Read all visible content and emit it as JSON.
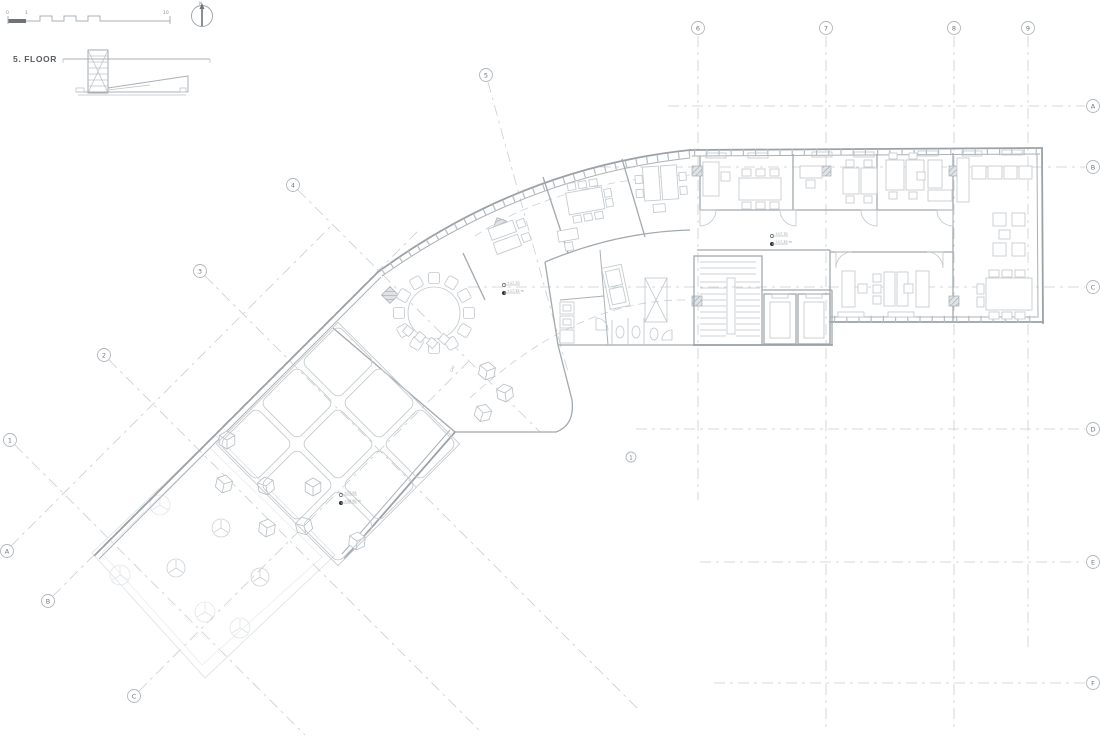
{
  "header": {
    "floor_label": "5. FLOOR",
    "north_label": "N",
    "scale_bar": {
      "zero": "0",
      "one": "1",
      "ten": "10"
    }
  },
  "grid": {
    "top": [
      "6",
      "7",
      "8",
      "9"
    ],
    "right": [
      "A",
      "B",
      "C",
      "D",
      "E",
      "F"
    ],
    "diag_numbers": [
      "5",
      "4",
      "3",
      "2",
      "1"
    ],
    "diag_letters": [
      "A",
      "B",
      "C"
    ],
    "inner_bubble": "1"
  },
  "annotations": {
    "atrium_level_upper": "+17.70",
    "atrium_level_lower": "+17.35 m",
    "corridor_level_upper": "+17.70",
    "corridor_level_lower": "+17.35 m",
    "terrace_level_upper": "+17.05",
    "terrace_level_lower": "+16.90 m",
    "tea_label": "Çay"
  },
  "colors": {
    "background": "#ffffff",
    "wall": "#9aa2a8",
    "line": "#aab1b6",
    "furniture": "#c3c9cd",
    "grid_dash": "#c9ced2",
    "faint": "#dde1e4",
    "text": "#565c61",
    "marker_dot": "#2e3338"
  }
}
